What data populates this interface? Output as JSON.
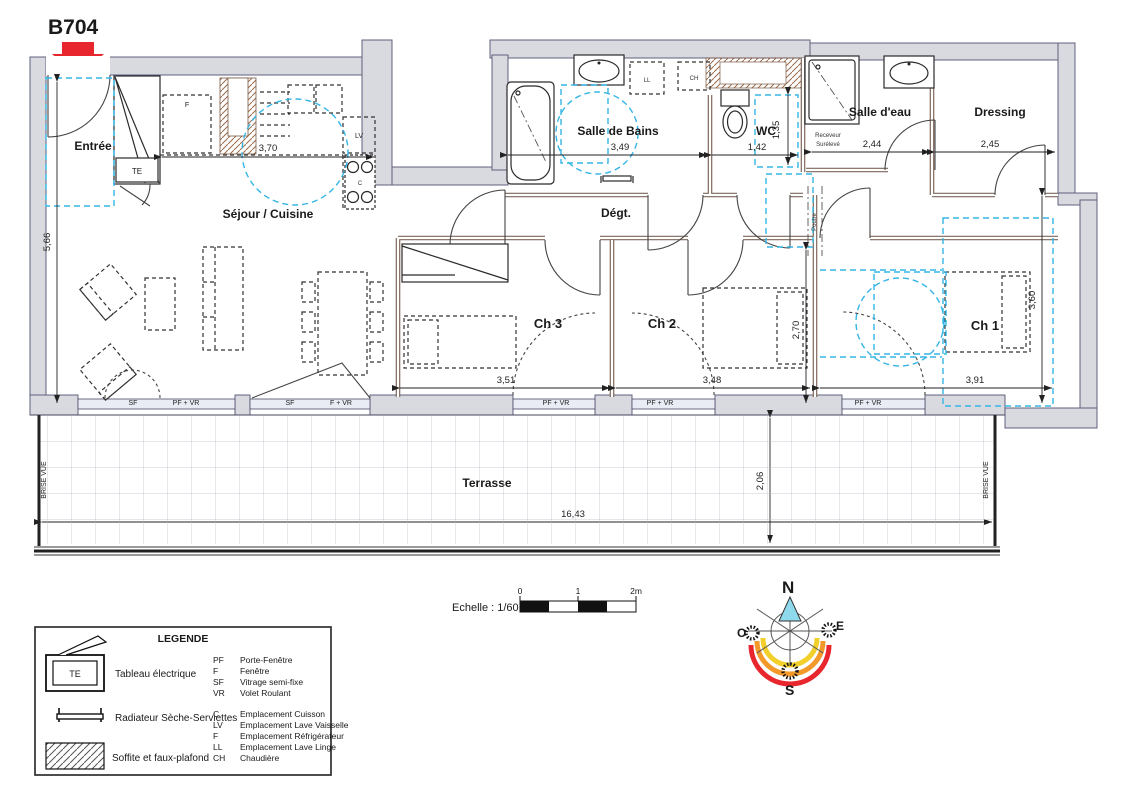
{
  "unit": {
    "id": "B704"
  },
  "rooms": {
    "entree": "Entrée",
    "sejour": "Séjour / Cuisine",
    "sdb": "Salle de Bains",
    "wc": "WC",
    "salle_eau": "Salle d'eau",
    "dressing": "Dressing",
    "degt": "Dégt.",
    "ch1": "Ch 1",
    "ch2": "Ch 2",
    "ch3": "Ch 3",
    "terrasse": "Terrasse"
  },
  "dims": {
    "sejour_w": "3,70",
    "sejour_h": "5,66",
    "sdb_w": "3,49",
    "wc_w": "1,42",
    "wc_h": "1,35",
    "salle_eau_w": "2,44",
    "dressing_w": "2,45",
    "ch3_w": "3,51",
    "ch2_w": "3,48",
    "ch2_h": "2,70",
    "ch1_w": "3,91",
    "ch1_h": "3,60",
    "terrasse_w": "16,43",
    "terrasse_h": "2,06"
  },
  "annotations": {
    "te": "TE",
    "fridge": "F",
    "lv": "LV",
    "cooking": "C",
    "ll": "LL",
    "ch_boiler": "CH",
    "receveur_l1": "Receveur",
    "receveur_l2": "Surélevé",
    "poutre": "Poutre",
    "brise_vue": "BRISE VUE",
    "windows": {
      "w1_sf": "SF",
      "w1_pfvr": "PF + VR",
      "w2_sf": "SF",
      "w2_fvr": "F + VR",
      "ch3": "PF + VR",
      "ch2": "PF + VR",
      "ch1": "PF + VR"
    }
  },
  "scale": {
    "label": "Echelle : 1/60",
    "t0": "0",
    "t1": "1",
    "t2": "2m"
  },
  "compass": {
    "n": "N",
    "e": "E",
    "s": "S",
    "o": "O"
  },
  "legend": {
    "title": "LEGENDE",
    "symbol_te": "TE",
    "items": [
      {
        "label": "Tableau électrique"
      },
      {
        "label": "Radiateur Sèche-Serviettes"
      },
      {
        "label": "Soffite et faux-plafond"
      }
    ],
    "abbrs": [
      {
        "k": "PF",
        "v": "Porte-Fenêtre"
      },
      {
        "k": "F",
        "v": "Fenêtre"
      },
      {
        "k": "SF",
        "v": "Vitrage semi-fixe"
      },
      {
        "k": "VR",
        "v": "Volet Roulant"
      },
      {
        "k": "C",
        "v": "Emplacement Cuisson"
      },
      {
        "k": "LV",
        "v": "Emplacement  Lave Vaisselle"
      },
      {
        "k": "F",
        "v": "Emplacement  Réfrigérateur"
      },
      {
        "k": "LL",
        "v": "Emplacement Lave Linge"
      },
      {
        "k": "CH",
        "v": "Chaudière"
      }
    ]
  },
  "colors": {
    "wall_fill": "#d9d9e0",
    "wall_edge": "#60607e",
    "partition": "#7d675a",
    "accent_cyan": "#35b5e5",
    "marker_red": "#e8262d",
    "compass_yellow": "#f2cf2a",
    "compass_orange": "#f2992a",
    "compass_north": "#8fd9ec"
  }
}
